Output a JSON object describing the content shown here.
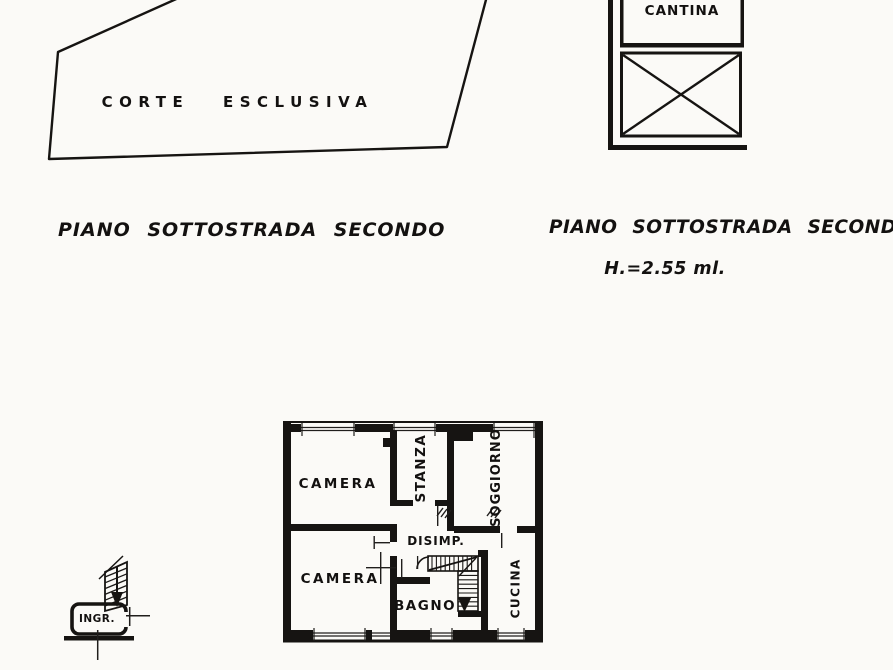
{
  "colors": {
    "ink": "#161412",
    "paper": "#fbfaf7"
  },
  "site_plan": {
    "label": "CORTE ESCLUSIVA"
  },
  "cellar": {
    "label": "CANTINA"
  },
  "captions": {
    "left_title": "PIANO SOTTOSTRADA SECONDO",
    "right_title": "PIANO SOTTOSTRADA SECONDO",
    "height_note": "H.=2.55 ml."
  },
  "apartment": {
    "rooms": [
      {
        "label": "CAMERA"
      },
      {
        "label": "STANZA"
      },
      {
        "label": "SOGGIORNO"
      },
      {
        "label": "CAMERA"
      },
      {
        "label": "DISIMP."
      },
      {
        "label": "BAGNO"
      },
      {
        "label": "CUCINA"
      }
    ]
  },
  "entrance": {
    "label": "INGR."
  }
}
